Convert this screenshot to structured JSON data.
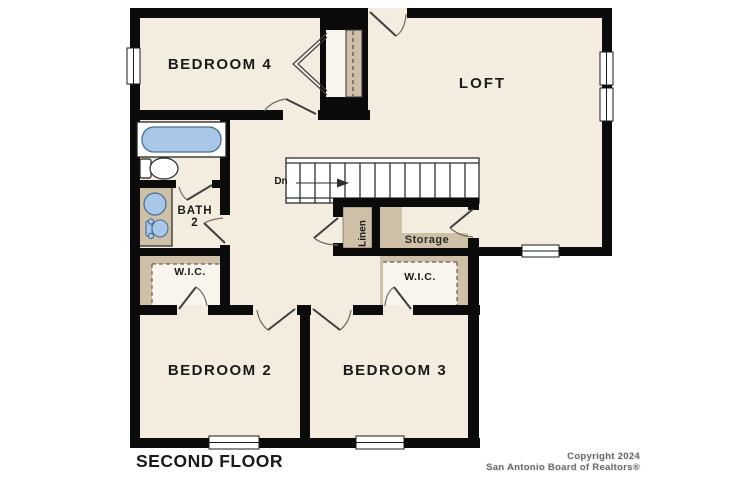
{
  "rooms": {
    "bedroom4": "BEDROOM 4",
    "loft": "LOFT",
    "bath_line1": "BATH",
    "bath_line2": "2",
    "wic_left": "W.I.C.",
    "wic_right": "W.I.C.",
    "linen": "Linen",
    "storage": "Storage",
    "bedroom2": "BEDROOM 2",
    "bedroom3": "BEDROOM 3"
  },
  "stairs": {
    "down_label": "Dn"
  },
  "footer": {
    "floor_label": "SECOND FLOOR",
    "copyright_line1": "Copyright 2024",
    "copyright_line2": "San Antonio Board of Realtors®"
  },
  "icons": {
    "fixtures": [
      "bathtub-icon",
      "toilet-icon",
      "sink-icon",
      "commode-icon"
    ]
  },
  "colors": {
    "room_fill": "#f4ecdf",
    "closet_fill": "#cfc1a8",
    "inner_closet_fill": "#f9f5ec",
    "wall": "#0b0b0b",
    "fixture_blue": "#a9c8e7",
    "fixture_blue_stroke": "#4a6e96"
  }
}
